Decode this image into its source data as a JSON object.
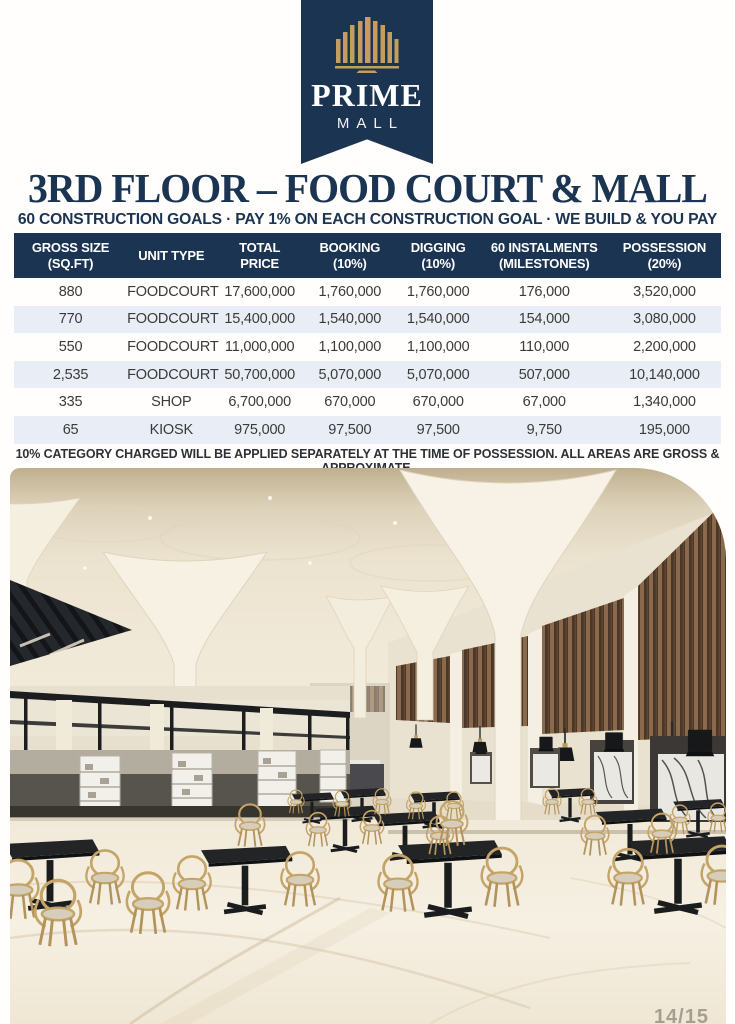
{
  "brand": {
    "name": "PRIME",
    "sub": "MALL"
  },
  "header": {
    "title": "3RD FLOOR – FOOD COURT & MALL",
    "subtitle": "60 CONSTRUCTION GOALS · PAY 1% ON EACH CONSTRUCTION GOAL · WE BUILD & YOU PAY"
  },
  "table": {
    "headers": [
      {
        "l1": "GROSS SIZE",
        "l2": "(SQ.FT)"
      },
      {
        "l1": "UNIT TYPE",
        "l2": ""
      },
      {
        "l1": "TOTAL",
        "l2": "PRICE"
      },
      {
        "l1": "BOOKING",
        "l2": "(10%)"
      },
      {
        "l1": "DIGGING",
        "l2": "(10%)"
      },
      {
        "l1": "60 INSTALMENTS",
        "l2": "(MILESTONES)"
      },
      {
        "l1": "POSSESSION",
        "l2": "(20%)"
      }
    ],
    "rows": [
      [
        "880",
        "FOODCOURT",
        "17,600,000",
        "1,760,000",
        "1,760,000",
        "176,000",
        "3,520,000"
      ],
      [
        "770",
        "FOODCOURT",
        "15,400,000",
        "1,540,000",
        "1,540,000",
        "154,000",
        "3,080,000"
      ],
      [
        "550",
        "FOODCOURT",
        "11,000,000",
        "1,100,000",
        "1,100,000",
        "110,000",
        "2,200,000"
      ],
      [
        "2,535",
        "FOODCOURT",
        "50,700,000",
        "5,070,000",
        "5,070,000",
        "507,000",
        "10,140,000"
      ],
      [
        "335",
        "SHOP",
        "6,700,000",
        "670,000",
        "670,000",
        "67,000",
        "1,340,000"
      ],
      [
        "65",
        "KIOSK",
        "975,000",
        "97,500",
        "97,500",
        "9,750",
        "195,000"
      ]
    ]
  },
  "note": "10% CATEGORY CHARGED WILL BE APPLIED SEPARATELY AT THE TIME OF POSSESSION. ALL AREAS ARE GROSS & APPROXIMATE.",
  "footer": {
    "page_number": "14/15"
  },
  "photo": {
    "description": "Food court interior render: white tulip columns, wood slat walls, black pendant lamps, food stalls, black tables and gold wire chairs on marble floor"
  },
  "colors": {
    "navy": "#1b3452",
    "gold": "#c49d5f",
    "row_stripe": "#e9eef6",
    "wood": "#8a6a4b",
    "chair_gold": "#c4a468"
  }
}
